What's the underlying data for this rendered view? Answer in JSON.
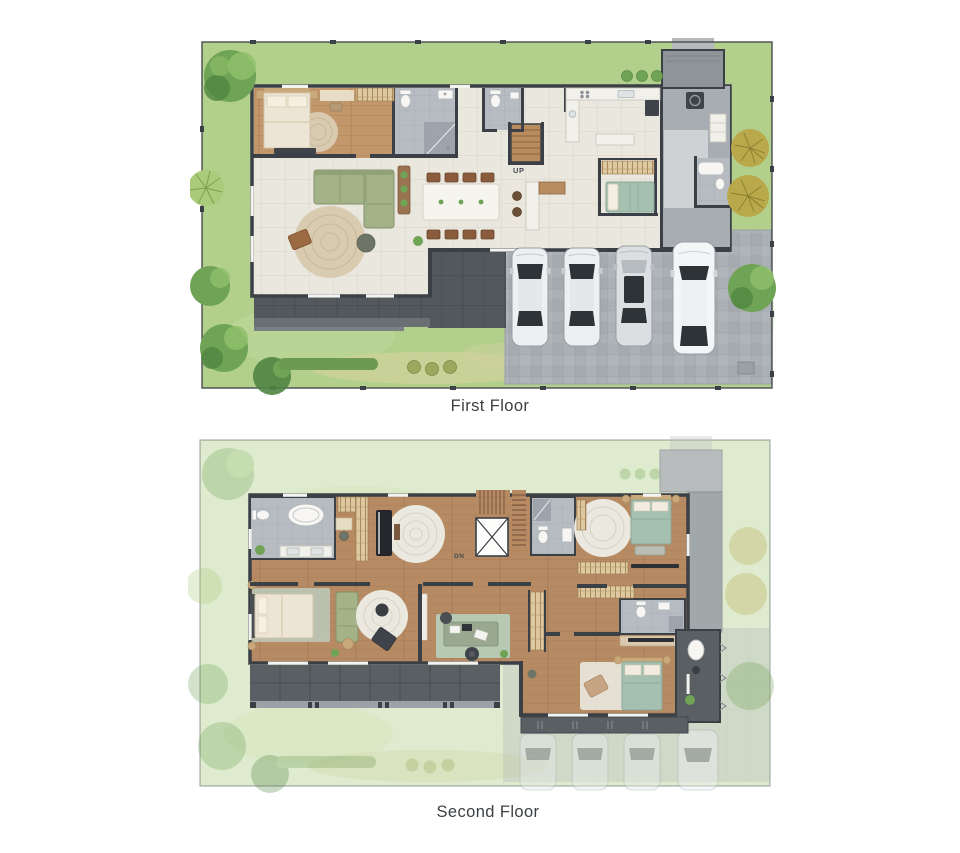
{
  "title": "Two-storey house floor plans",
  "floors": [
    {
      "caption": "First Floor",
      "stair_label": "UP"
    },
    {
      "caption": "Second Floor",
      "stair_label": "DN"
    }
  ],
  "palette": {
    "page_bg": "#ffffff",
    "lawn": "#b2cf8c",
    "lawn_light": "#c7dda3",
    "lawn_dry": "#cfd29b",
    "hedge": "#6d9a52",
    "tree_dark": "#4f8440",
    "tree_mid": "#6fa355",
    "tree_light": "#8fbf6b",
    "palm": "#a9cb7a",
    "olive": "#b9a94b",
    "wall": "#3b4046",
    "floor_cream": "#eae7de",
    "grout": "#dbd6ca",
    "wood": "#c2976b",
    "wood_line": "#a87e54",
    "wood2": "#b68a63",
    "wood2_line": "#9d7350",
    "tile_gray": "#b6bcc2",
    "tile_gray_line": "#a6acb2",
    "shower_gray": "#99a0a7",
    "wing_gray": "#a7adb2",
    "corridor_gray": "#ced2d5",
    "porch_gray": "#8e9499",
    "deck": "#53585d",
    "deck_line": "#45494e",
    "paver": "#abb0b4",
    "paver_line": "#9aa0a5",
    "balcony": "#5a5f64",
    "railing": "#9ba1a6",
    "sofa_green": "#a3b287",
    "sofa_green_dark": "#85926b",
    "bed_green": "#a5c0b0",
    "bed_white": "#ece4d4",
    "headboard": "#c9a87c",
    "rug_jute": "#d9cbb0",
    "rug_white": "#ebe8df",
    "furn_brown": "#8a5c3c",
    "counter_white": "#f1f0ea",
    "appliance_dark": "#3f444a",
    "car_white": "#edeff0",
    "car_silver": "#dcdfe1",
    "car_glass": "#2e3338",
    "caption_color": "#3c4043"
  }
}
